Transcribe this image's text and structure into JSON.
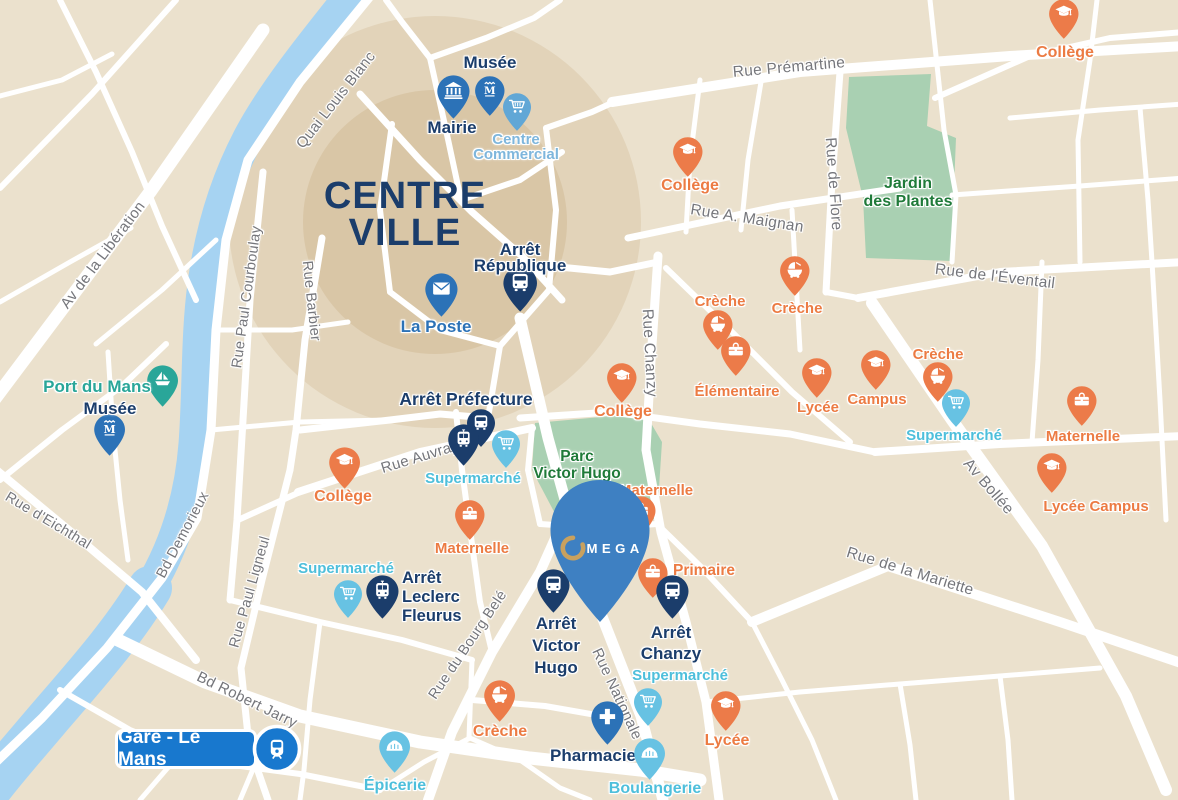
{
  "colors": {
    "background": "#EBE1CD",
    "street": "#FFFFFF",
    "river": "#A6D3F2",
    "park": "#A9D0B2",
    "centre_zone_outer": "#D9C6A5",
    "centre_zone_inner": "#D2BC97",
    "navy": "#1B3D6B",
    "blue": "#2C72B7",
    "steel": "#61A7D6",
    "cyan": "#67C2E3",
    "teal": "#29A699",
    "orange": "#EC7B49",
    "orange_text": "#EC7B43",
    "lightblue_text": "#7EB6DC",
    "cyan_text": "#4EBFDB",
    "green_text": "#1F7A39",
    "street_text": "#75767B",
    "gare_blue": "#1878CE",
    "omega_blue": "#3E80C2",
    "omega_gold": "#C8A15F"
  },
  "map": {
    "title": {
      "line1": "CENTRE",
      "line2": "VILLE",
      "x": 405,
      "y": 196,
      "lh": 37,
      "size": 38,
      "color": "#1B3D6B"
    },
    "area_labels": [
      {
        "id": "parc-victor-hugo",
        "lines": [
          "Parc",
          "Victor Hugo"
        ],
        "x": 577,
        "y": 456,
        "lh": 17,
        "size": 15.5
      },
      {
        "id": "jardin-des-plantes",
        "lines": [
          "Jardin",
          "des Plantes"
        ],
        "x": 908,
        "y": 184,
        "lh": 18,
        "size": 16
      }
    ],
    "street_labels": [
      {
        "text": "Quai Louis Blanc",
        "x": 336,
        "y": 100,
        "rot": -52,
        "size": 15
      },
      {
        "text": "Av de la Libération",
        "x": 103,
        "y": 255,
        "rot": -53,
        "size": 15
      },
      {
        "text": "Rue Paul Courboulay",
        "x": 247,
        "y": 297,
        "rot": -82,
        "size": 14.5
      },
      {
        "text": "Rue Barbier",
        "x": 311,
        "y": 301,
        "rot": 84,
        "size": 14.5
      },
      {
        "text": "Rue Prémartine",
        "x": 789,
        "y": 68,
        "rot": -5,
        "size": 15.5
      },
      {
        "text": "Rue A. Maignan",
        "x": 747,
        "y": 219,
        "rot": 9,
        "size": 15.5
      },
      {
        "text": "Rue de Flore",
        "x": 833,
        "y": 184,
        "rot": 86,
        "size": 15.5
      },
      {
        "text": "Rue de l'Éventail",
        "x": 995,
        "y": 277,
        "rot": 7,
        "size": 15.5
      },
      {
        "text": "Rue Chanzy",
        "x": 649,
        "y": 353,
        "rot": 87,
        "size": 15.5
      },
      {
        "text": "Rue Auvray",
        "x": 420,
        "y": 457,
        "rot": -17,
        "size": 15
      },
      {
        "text": "Av Bollée",
        "x": 988,
        "y": 487,
        "rot": 49,
        "size": 15.5
      },
      {
        "text": "Rue de la Mariette",
        "x": 910,
        "y": 572,
        "rot": 17,
        "size": 15.5
      },
      {
        "text": "Rue d'Eichthal",
        "x": 48,
        "y": 521,
        "rot": 31,
        "size": 14.5
      },
      {
        "text": "Bd Demorieux",
        "x": 183,
        "y": 535,
        "rot": -62,
        "size": 14.5
      },
      {
        "text": "Rue Paul Ligneul",
        "x": 250,
        "y": 592,
        "rot": -74,
        "size": 14.5
      },
      {
        "text": "Rue du Bourg Belé",
        "x": 468,
        "y": 645,
        "rot": -56,
        "size": 14.5
      },
      {
        "text": "Rue Nationale",
        "x": 617,
        "y": 694,
        "rot": 65,
        "size": 15
      },
      {
        "text": "Bd Robert Jarry",
        "x": 247,
        "y": 700,
        "rot": 26,
        "size": 15
      }
    ],
    "pois": [
      {
        "id": "musee-centre",
        "icon": "museum",
        "pin_color": "blue",
        "x": 490,
        "y": 117,
        "size": 42,
        "label_lines": [
          "Musée"
        ],
        "label": {
          "x": 490,
          "y": 62,
          "size": 17,
          "color": "navy",
          "lh": 17,
          "align": "center"
        }
      },
      {
        "id": "mairie",
        "icon": "bank",
        "pin_color": "blue",
        "x": 453,
        "y": 120,
        "size": 46,
        "label_lines": [
          "Mairie"
        ],
        "label": {
          "x": 452,
          "y": 127,
          "size": 17,
          "color": "navy",
          "lh": 17,
          "align": "center"
        }
      },
      {
        "id": "centre-commercial",
        "icon": "cart",
        "pin_color": "steel",
        "x": 517,
        "y": 132,
        "size": 40,
        "label_lines": [
          "Centre",
          "Commercial"
        ],
        "label": {
          "x": 516,
          "y": 139,
          "size": 15,
          "color": "lightblue",
          "lh": 15,
          "align": "center"
        }
      },
      {
        "id": "arret-republique",
        "icon": "bus",
        "pin_color": "navy",
        "x": 520,
        "y": 313,
        "size": 48,
        "label_lines": [
          "Arrêt",
          "République"
        ],
        "label": {
          "x": 520,
          "y": 250,
          "size": 17,
          "color": "navy",
          "lh": 16,
          "align": "center"
        }
      },
      {
        "id": "la-poste",
        "icon": "envelope",
        "pin_color": "blue",
        "x": 441,
        "y": 318,
        "size": 46,
        "label_lines": [
          "La Poste"
        ],
        "label": {
          "x": 436,
          "y": 326,
          "size": 17,
          "color": "blue",
          "lh": 17,
          "align": "center"
        }
      },
      {
        "id": "port-du-mans",
        "icon": "boat",
        "pin_color": "teal",
        "x": 163,
        "y": 408,
        "size": 44,
        "label_lines": [
          "Port du Mans"
        ],
        "label": {
          "x": 97,
          "y": 386,
          "size": 17,
          "color": "teal",
          "lh": 17,
          "align": "center"
        }
      },
      {
        "id": "musee-ouest",
        "icon": "museum",
        "pin_color": "blue",
        "x": 110,
        "y": 457,
        "size": 44,
        "label_lines": [
          "Musée"
        ],
        "label": {
          "x": 110,
          "y": 408,
          "size": 17,
          "color": "navy",
          "lh": 17,
          "align": "center"
        }
      },
      {
        "id": "arret-prefecture-bus",
        "icon": "bus",
        "pin_color": "navy",
        "x": 481,
        "y": 448,
        "size": 40,
        "label_lines": [],
        "label": null
      },
      {
        "id": "arret-prefecture",
        "icon": "tram",
        "pin_color": "navy",
        "x": 464,
        "y": 467,
        "size": 44,
        "label_lines": [
          "Arrêt Préfecture"
        ],
        "label": {
          "x": 466,
          "y": 399,
          "size": 17.5,
          "color": "navy",
          "lh": 17,
          "align": "center"
        }
      },
      {
        "id": "supermarche-centre",
        "icon": "cart",
        "pin_color": "cyan",
        "x": 506,
        "y": 469,
        "size": 40,
        "label_lines": [
          "Supermarché"
        ],
        "label": {
          "x": 473,
          "y": 478,
          "size": 15,
          "color": "cyan",
          "lh": 15,
          "align": "center"
        }
      },
      {
        "id": "college-ouest",
        "icon": "gradcap",
        "pin_color": "orange",
        "x": 345,
        "y": 490,
        "size": 44,
        "label_lines": [
          "Collège"
        ],
        "label": {
          "x": 343,
          "y": 497,
          "size": 16,
          "color": "orange",
          "lh": 16,
          "align": "center"
        }
      },
      {
        "id": "college-nord",
        "icon": "gradcap",
        "pin_color": "orange",
        "x": 688,
        "y": 178,
        "size": 42,
        "label_lines": [
          "Collège"
        ],
        "label": {
          "x": 690,
          "y": 186,
          "size": 16,
          "color": "orange",
          "lh": 16,
          "align": "center"
        }
      },
      {
        "id": "college-nord-est",
        "icon": "gradcap",
        "pin_color": "orange",
        "x": 1064,
        "y": 40,
        "size": 42,
        "label_lines": [
          "Collège"
        ],
        "label": {
          "x": 1065,
          "y": 53,
          "size": 16,
          "color": "orange",
          "lh": 16,
          "align": "center"
        }
      },
      {
        "id": "college-parc",
        "icon": "gradcap",
        "pin_color": "orange",
        "x": 622,
        "y": 404,
        "size": 42,
        "label_lines": [
          "Collège"
        ],
        "label": {
          "x": 623,
          "y": 412,
          "size": 16,
          "color": "orange",
          "lh": 16,
          "align": "center"
        }
      },
      {
        "id": "maternelle-ouest",
        "icon": "satchel",
        "pin_color": "orange",
        "x": 470,
        "y": 541,
        "size": 42,
        "label_lines": [
          "Maternelle"
        ],
        "label": {
          "x": 472,
          "y": 548,
          "size": 15,
          "color": "orange",
          "lh": 15,
          "align": "center"
        }
      },
      {
        "id": "supermarche-ouest",
        "icon": "cart",
        "pin_color": "cyan",
        "x": 348,
        "y": 619,
        "size": 40,
        "label_lines": [
          "Supermarché"
        ],
        "label": {
          "x": 346,
          "y": 568,
          "size": 15,
          "color": "cyan",
          "lh": 15,
          "align": "center"
        }
      },
      {
        "id": "arret-leclerc-fleurus",
        "icon": "tram",
        "pin_color": "navy",
        "x": 382,
        "y": 620,
        "size": 46,
        "label_lines": [
          "Arrêt",
          "Leclerc",
          "Fleurus"
        ],
        "label": {
          "x": 402,
          "y": 578,
          "size": 16.5,
          "color": "navy",
          "lh": 19,
          "align": "left"
        }
      },
      {
        "id": "creche-centre-1",
        "icon": "pram",
        "pin_color": "orange",
        "x": 718,
        "y": 351,
        "size": 42,
        "label_lines": [
          "Crèche"
        ],
        "label": {
          "x": 720,
          "y": 301,
          "size": 15,
          "color": "orange",
          "lh": 15,
          "align": "center"
        }
      },
      {
        "id": "creche-centre-2",
        "icon": "pram",
        "pin_color": "orange",
        "x": 795,
        "y": 297,
        "size": 42,
        "label_lines": [
          "Crèche"
        ],
        "label": {
          "x": 797,
          "y": 308,
          "size": 15,
          "color": "orange",
          "lh": 15,
          "align": "center"
        }
      },
      {
        "id": "elementaire",
        "icon": "satchel",
        "pin_color": "orange",
        "x": 736,
        "y": 377,
        "size": 42,
        "label_lines": [
          "Élémentaire"
        ],
        "label": {
          "x": 737,
          "y": 391,
          "size": 15,
          "color": "orange",
          "lh": 15,
          "align": "center"
        }
      },
      {
        "id": "lycee-centre",
        "icon": "gradcap",
        "pin_color": "orange",
        "x": 817,
        "y": 399,
        "size": 42,
        "label_lines": [
          "Lycée"
        ],
        "label": {
          "x": 818,
          "y": 407,
          "size": 15,
          "color": "orange",
          "lh": 15,
          "align": "center"
        }
      },
      {
        "id": "campus",
        "icon": "gradcap",
        "pin_color": "orange",
        "x": 876,
        "y": 391,
        "size": 42,
        "label_lines": [
          "Campus"
        ],
        "label": {
          "x": 877,
          "y": 399,
          "size": 15,
          "color": "orange",
          "lh": 15,
          "align": "center"
        }
      },
      {
        "id": "creche-est",
        "icon": "pram",
        "pin_color": "orange",
        "x": 938,
        "y": 403,
        "size": 42,
        "label_lines": [
          "Crèche"
        ],
        "label": {
          "x": 938,
          "y": 354,
          "size": 15,
          "color": "orange",
          "lh": 15,
          "align": "center"
        }
      },
      {
        "id": "supermarche-est",
        "icon": "cart",
        "pin_color": "cyan",
        "x": 956,
        "y": 428,
        "size": 40,
        "label_lines": [
          "Supermarché"
        ],
        "label": {
          "x": 954,
          "y": 435,
          "size": 15,
          "color": "cyan",
          "lh": 15,
          "align": "center"
        }
      },
      {
        "id": "maternelle-est",
        "icon": "satchel",
        "pin_color": "orange",
        "x": 1082,
        "y": 427,
        "size": 42,
        "label_lines": [
          "Maternelle"
        ],
        "label": {
          "x": 1083,
          "y": 436,
          "size": 15,
          "color": "orange",
          "lh": 15,
          "align": "center"
        }
      },
      {
        "id": "lycee-campus",
        "icon": "gradcap",
        "pin_color": "orange",
        "x": 1052,
        "y": 494,
        "size": 42,
        "label_lines": [
          "Lycée Campus"
        ],
        "label": {
          "x": 1096,
          "y": 506,
          "size": 15,
          "color": "orange",
          "lh": 15,
          "align": "center"
        }
      },
      {
        "id": "maternelle-sud",
        "icon": "satchel",
        "pin_color": "orange",
        "x": 641,
        "y": 537,
        "size": 42,
        "label_lines": [
          "Maternelle"
        ],
        "label": {
          "x": 656,
          "y": 490,
          "size": 15,
          "color": "orange",
          "lh": 15,
          "align": "center"
        }
      },
      {
        "id": "primaire",
        "icon": "satchel",
        "pin_color": "orange",
        "x": 653,
        "y": 599,
        "size": 42,
        "label_lines": [
          "Primaire"
        ],
        "label": {
          "x": 704,
          "y": 570,
          "size": 15.5,
          "color": "orange",
          "lh": 15,
          "align": "center"
        }
      },
      {
        "id": "arret-victor-hugo",
        "icon": "bus",
        "pin_color": "navy",
        "x": 553,
        "y": 614,
        "size": 46,
        "label_lines": [
          "Arrêt",
          "Victor",
          "Hugo"
        ],
        "label": {
          "x": 556,
          "y": 624,
          "size": 17,
          "color": "navy",
          "lh": 22,
          "align": "center"
        }
      },
      {
        "id": "arret-chanzy",
        "icon": "bus",
        "pin_color": "navy",
        "x": 672,
        "y": 620,
        "size": 46,
        "label_lines": [
          "Arrêt",
          "Chanzy"
        ],
        "label": {
          "x": 671,
          "y": 632,
          "size": 17,
          "color": "navy",
          "lh": 21,
          "align": "center"
        }
      },
      {
        "id": "supermarche-sud",
        "icon": "cart",
        "pin_color": "cyan",
        "x": 648,
        "y": 727,
        "size": 40,
        "label_lines": [
          "Supermarché"
        ],
        "label": {
          "x": 680,
          "y": 675,
          "size": 15,
          "color": "cyan",
          "lh": 15,
          "align": "center"
        }
      },
      {
        "id": "lycee-sud",
        "icon": "gradcap",
        "pin_color": "orange",
        "x": 726,
        "y": 732,
        "size": 42,
        "label_lines": [
          "Lycée"
        ],
        "label": {
          "x": 727,
          "y": 741,
          "size": 16,
          "color": "orange",
          "lh": 16,
          "align": "center"
        }
      },
      {
        "id": "creche-sud",
        "icon": "pram",
        "pin_color": "orange",
        "x": 500,
        "y": 723,
        "size": 44,
        "label_lines": [
          "Crèche"
        ],
        "label": {
          "x": 500,
          "y": 732,
          "size": 16,
          "color": "orange",
          "lh": 16,
          "align": "center"
        }
      },
      {
        "id": "pharmacie",
        "icon": "cross",
        "pin_color": "blue",
        "x": 607,
        "y": 746,
        "size": 46,
        "label_lines": [
          "Pharmacie"
        ],
        "label": {
          "x": 593,
          "y": 755,
          "size": 17,
          "color": "navy",
          "lh": 17,
          "align": "center"
        }
      },
      {
        "id": "boulangerie",
        "icon": "basket",
        "pin_color": "cyan",
        "x": 650,
        "y": 781,
        "size": 44,
        "label_lines": [
          "Boulangerie"
        ],
        "label": {
          "x": 655,
          "y": 789,
          "size": 16,
          "color": "cyan",
          "lh": 16,
          "align": "center"
        }
      },
      {
        "id": "epicerie",
        "icon": "basket",
        "pin_color": "cyan",
        "x": 395,
        "y": 774,
        "size": 44,
        "label_lines": [
          "Épicerie"
        ],
        "label": {
          "x": 395,
          "y": 786,
          "size": 16,
          "color": "cyan",
          "lh": 16,
          "align": "center"
        }
      }
    ],
    "gare_badge": {
      "label": "Gare - Le Mans",
      "x": 115,
      "y": 729,
      "w": 142,
      "h": 40,
      "icon": "train",
      "cx": 277,
      "cy": 749,
      "r": 23
    },
    "omega_pin": {
      "brand_text": "MEGA",
      "x": 600,
      "tip_y": 622
    }
  }
}
